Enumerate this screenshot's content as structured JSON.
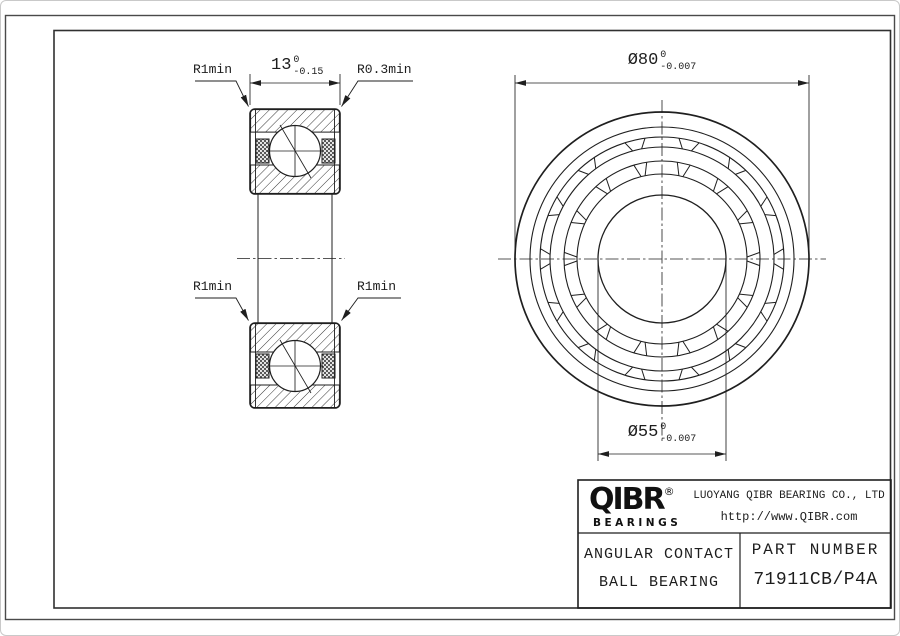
{
  "drawing": {
    "dimensions": {
      "width": {
        "value": "13",
        "tol_upper": "0",
        "tol_lower": "-0.15"
      },
      "outer_diameter": {
        "symbol": "Ø",
        "value": "80",
        "tol_upper": "0",
        "tol_lower": "-0.007"
      },
      "bore_diameter": {
        "symbol": "Ø",
        "value": "55",
        "tol_upper": "0",
        "tol_lower": "-0.007"
      },
      "radius_labels": {
        "top_left": "R1min",
        "top_right": "R0.3min",
        "mid_left": "R1min",
        "mid_right": "R1min"
      }
    },
    "front_view": {
      "pocket_count": 14
    }
  },
  "title_block": {
    "logo": {
      "name": "QIBR",
      "registered": "®",
      "tagline": "BEARINGS"
    },
    "company_name": "LUOYANG QIBR BEARING CO., LTD",
    "website": "http://www.QIBR.com",
    "product_type_line1": "ANGULAR CONTACT",
    "product_type_line2": "BALL BEARING",
    "part_number_label": "PART NUMBER",
    "part_number": "71911CB/P4A"
  },
  "colors": {
    "line": "#1f1f1f",
    "background": "#ffffff"
  }
}
